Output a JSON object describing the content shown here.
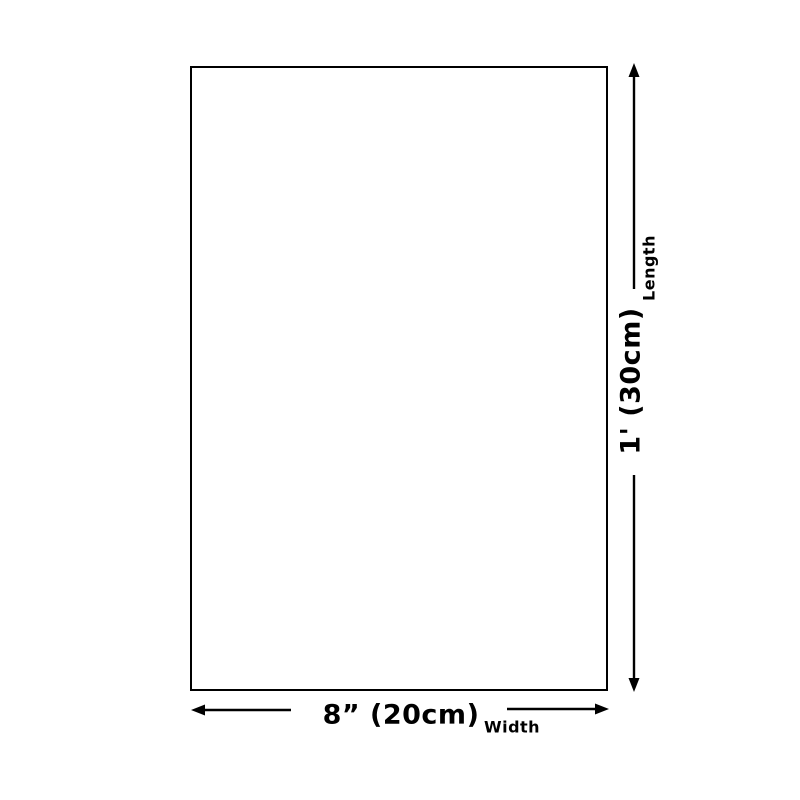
{
  "page": {
    "background_color": "#ffffff",
    "line_color": "#000000"
  },
  "diagram": {
    "type": "product-dimension-diagram",
    "shape": "rectangle",
    "width_dimension": {
      "value": "8” (20cm)",
      "axis_label": "Width"
    },
    "length_dimension": {
      "value": "1' (30cm)",
      "axis_label": "Length"
    },
    "icons": {
      "up": "arrow-up-icon",
      "down": "arrow-down-icon",
      "left": "arrow-left-icon",
      "right": "arrow-right-icon"
    }
  }
}
